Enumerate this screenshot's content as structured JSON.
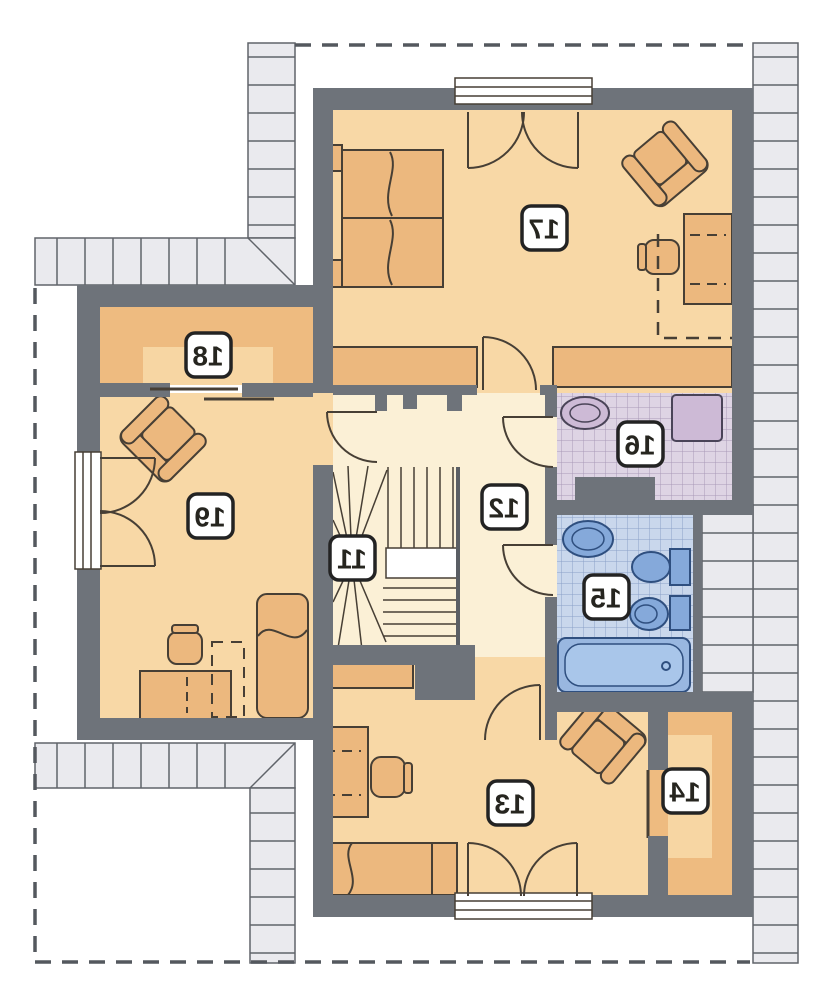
{
  "plan": {
    "kind": "attic-floor-plan",
    "labels_mirrored": true,
    "rooms": [
      {
        "number": "11",
        "role": "staircase"
      },
      {
        "number": "12",
        "role": "hall"
      },
      {
        "number": "13",
        "role": "bedroom-south"
      },
      {
        "number": "14",
        "role": "wardrobe-south"
      },
      {
        "number": "15",
        "role": "bathroom"
      },
      {
        "number": "16",
        "role": "utility-room"
      },
      {
        "number": "17",
        "role": "bedroom-north"
      },
      {
        "number": "18",
        "role": "wardrobe-west"
      },
      {
        "number": "19",
        "role": "bedroom-west"
      }
    ],
    "colors": {
      "wall": "#6e737a",
      "room_peach": "#f8d8a6",
      "room_cream": "#fbf0d6",
      "room_tan": "#eebb80",
      "room_tan_light": "#f7d6a3",
      "furniture": "#ecb87e",
      "tile_blue": "#c9d7ec",
      "tile_blue_grid": "#8aa0c8",
      "fixture_blue": "#85a9da",
      "tile_purple": "#ded4e4",
      "tile_purple_grid": "#a99ab8",
      "fixture_purple": "#cdbad6",
      "roof_hatch": "#eaeaee",
      "outline": "#473f35",
      "dashed_line": "#54585e"
    }
  }
}
